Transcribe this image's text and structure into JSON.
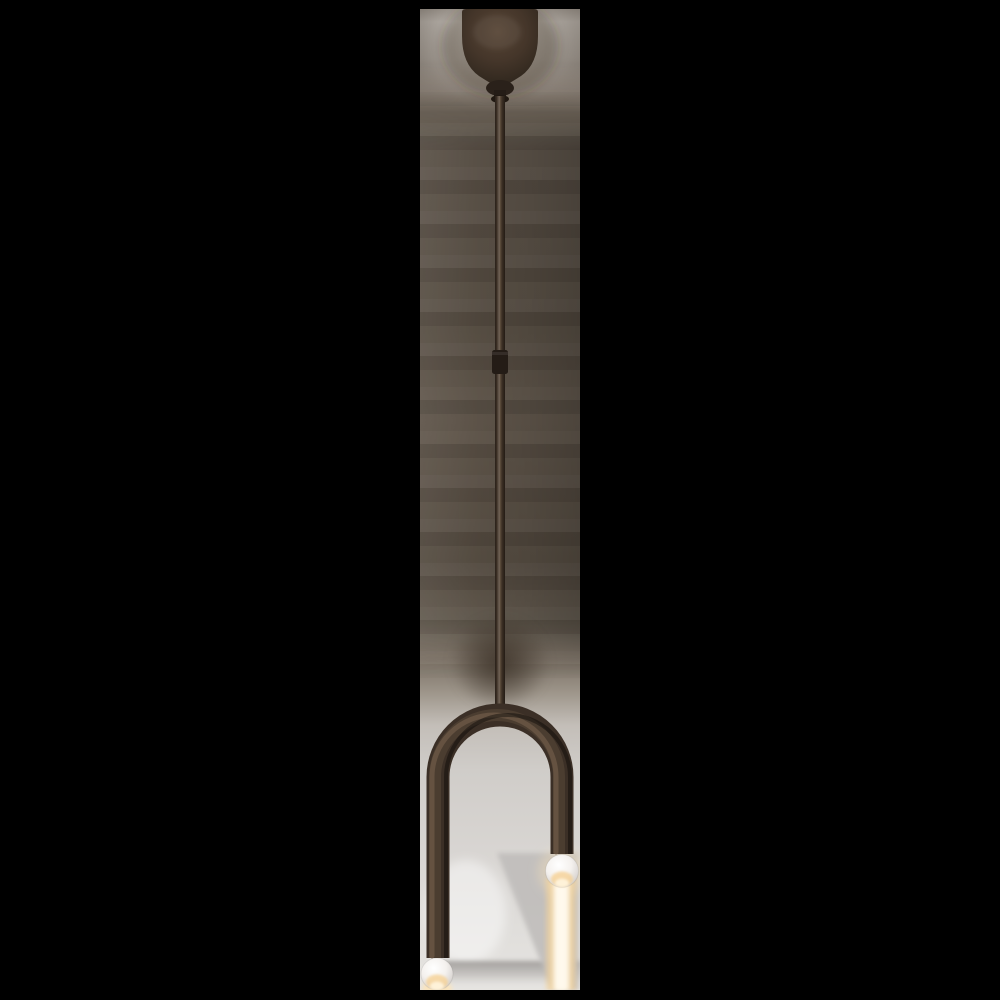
{
  "scene": {
    "type": "product-photo",
    "subject": "Asymmetric two-light pendant lamp in dark bronze finish: ceiling canopy, long thin stem, inverted-U arm with uneven legs, each tipped with a small lit white globe bulb casting a warm light beam",
    "background": "black letterbox surrounding a narrow vertical photo strip"
  },
  "colors": {
    "canvas_background": "#000000",
    "bronze_dark": "#3b2f26",
    "bronze_mid": "#4e3f32",
    "bronze_highlight": "#6b5846",
    "backdrop_top": "#c4beb7",
    "backdrop_dark": "#564d42",
    "backdrop_bottom": "#e6e4e1",
    "bulb_white": "#f4f1ee",
    "glow_warm": "#f5d59e",
    "glow_bright": "#fff4de"
  },
  "parts": {
    "canopy": "ceiling canopy dome",
    "stem": "hanging stem rod",
    "stem_joint": "stem connector joint",
    "arch": "inverted U-shaped arm, left leg longer than right",
    "bulb_right": "upper globe bulb (right arm, lit)",
    "bulb_left": "lower globe bulb (left arm, lit)",
    "glow": "warm vertical light beam below right bulb",
    "backdrop_shadow": "diagonal gray shadow cast on backdrop",
    "floor_shadow": "soft horizontal shadow band near bottom"
  }
}
